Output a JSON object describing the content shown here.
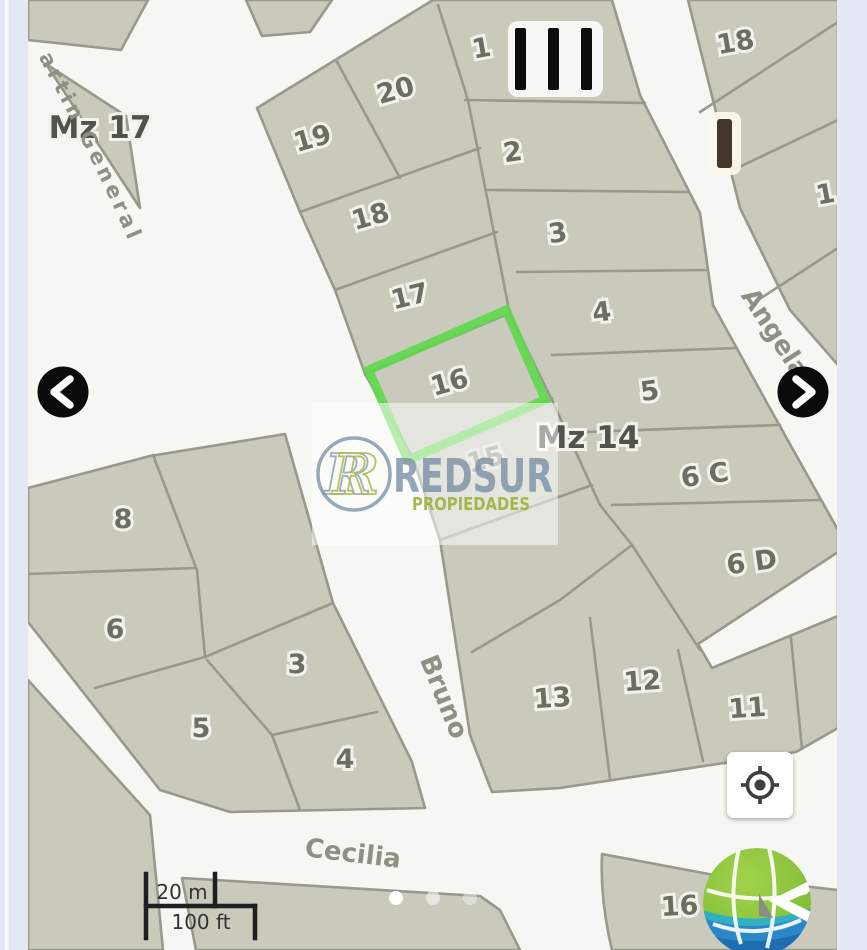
{
  "map": {
    "block_labels": [
      {
        "text": "Mz 17",
        "x": 100,
        "y": 138,
        "rot": 0
      },
      {
        "text": "Mz 14",
        "x": 588,
        "y": 448,
        "rot": 0
      }
    ],
    "street_labels": [
      {
        "text": "Bruno",
        "x": 436,
        "y": 700,
        "rot": 68
      },
      {
        "text": "Cecilia",
        "x": 352,
        "y": 862,
        "rot": 7
      },
      {
        "text": "Angela",
        "x": 768,
        "y": 338,
        "rot": 57
      }
    ],
    "curved_street_label": "Circuito San Martin General",
    "parcel_labels": [
      {
        "text": "1",
        "x": 483,
        "y": 57,
        "rot": -10
      },
      {
        "text": "2",
        "x": 514,
        "y": 161,
        "rot": -8
      },
      {
        "text": "3",
        "x": 559,
        "y": 242,
        "rot": -8
      },
      {
        "text": "4",
        "x": 603,
        "y": 321,
        "rot": -8
      },
      {
        "text": "5",
        "x": 651,
        "y": 400,
        "rot": -8
      },
      {
        "text": "6 C",
        "x": 706,
        "y": 484,
        "rot": -8
      },
      {
        "text": "6 D",
        "x": 753,
        "y": 571,
        "rot": -8
      },
      {
        "text": "20",
        "x": 398,
        "y": 99,
        "rot": -16
      },
      {
        "text": "19",
        "x": 315,
        "y": 147,
        "rot": -16
      },
      {
        "text": "18",
        "x": 373,
        "y": 225,
        "rot": -16
      },
      {
        "text": "17",
        "x": 412,
        "y": 305,
        "rot": -14
      },
      {
        "text": "16",
        "x": 452,
        "y": 391,
        "rot": -16
      },
      {
        "text": "15",
        "x": 488,
        "y": 468,
        "rot": -16,
        "faded": true
      },
      {
        "text": "13",
        "x": 553,
        "y": 707,
        "rot": -4
      },
      {
        "text": "12",
        "x": 643,
        "y": 690,
        "rot": -4
      },
      {
        "text": "11",
        "x": 748,
        "y": 717,
        "rot": -4
      },
      {
        "text": "18",
        "x": 737,
        "y": 51,
        "rot": -10
      },
      {
        "text": "1",
        "x": 827,
        "y": 203,
        "rot": -10
      },
      {
        "text": "8",
        "x": 123,
        "y": 528,
        "rot": 0
      },
      {
        "text": "6",
        "x": 115,
        "y": 638,
        "rot": 0
      },
      {
        "text": "5",
        "x": 201,
        "y": 737,
        "rot": 0
      },
      {
        "text": "3",
        "x": 297,
        "y": 673,
        "rot": 0
      },
      {
        "text": "4",
        "x": 345,
        "y": 768,
        "rot": 0
      },
      {
        "text": "16",
        "x": 680,
        "y": 915,
        "rot": -3
      }
    ],
    "highlighted_parcel": "16",
    "scale_bar": {
      "metric": "20 m",
      "imperial": "100 ft"
    }
  },
  "carousel": {
    "dots": [
      {
        "opacity": 1.0
      },
      {
        "opacity": 0.55
      },
      {
        "opacity": 0.38
      }
    ]
  },
  "watermark": {
    "monogram": "R",
    "brand": "REDSUR",
    "tagline": "PROPIEDADES"
  },
  "colors": {
    "highlight_green": "#5fd94b",
    "parcel_fill": "#c9cabc",
    "street_white": "#f6f6f2",
    "side_strip": "#e4e8f5",
    "logo_green": "#8cc63e",
    "logo_blue": "#2b87c8"
  }
}
